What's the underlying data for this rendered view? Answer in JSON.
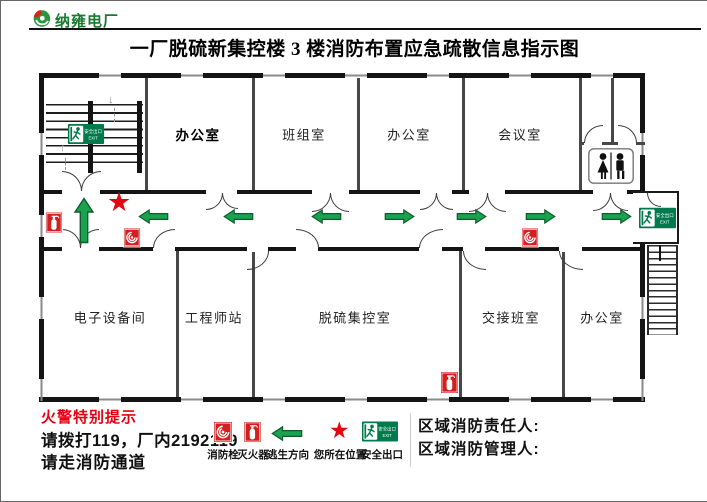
{
  "header": {
    "logo_text": "纳雍电厂",
    "title": "一厂脱硫新集控楼 3 楼消防布置应急疏散信息指示图"
  },
  "floor_plan": {
    "rooms_top": [
      {
        "label": "办公室"
      },
      {
        "label": "班组室"
      },
      {
        "label": "办公室"
      },
      {
        "label": "会议室"
      }
    ],
    "rooms_bottom": [
      {
        "label": "电子设备间"
      },
      {
        "label": "工程师站"
      },
      {
        "label": "脱硫集控室"
      },
      {
        "label": "交接班室"
      },
      {
        "label": "办公室"
      }
    ],
    "exit_sign": {
      "text_cn": "安全出口",
      "text_en": "EXIT"
    }
  },
  "warning": {
    "heading": "火警特别提示",
    "line1": "请拨打119，厂内2192119",
    "line2": "请走消防通道"
  },
  "legend": {
    "items": [
      {
        "icon": "fire-hydrant-icon",
        "label": "消防栓"
      },
      {
        "icon": "fire-extinguisher-icon",
        "label": "灭火器"
      },
      {
        "icon": "escape-direction-arrow",
        "label": "逃生方向"
      },
      {
        "icon": "your-location-star",
        "label": "您所在位置"
      },
      {
        "icon": "safety-exit-sign",
        "label": "安全出口"
      }
    ]
  },
  "contacts": {
    "responsible": "区域消防责任人:",
    "manager": "区域消防管理人:"
  },
  "colors": {
    "arrow_green": "#1ba24e",
    "exit_green": "#007a4d",
    "icon_red": "#d41f1f",
    "star_red": "#e30613",
    "logo_green": "#177a30",
    "warning_red": "#e60012"
  }
}
